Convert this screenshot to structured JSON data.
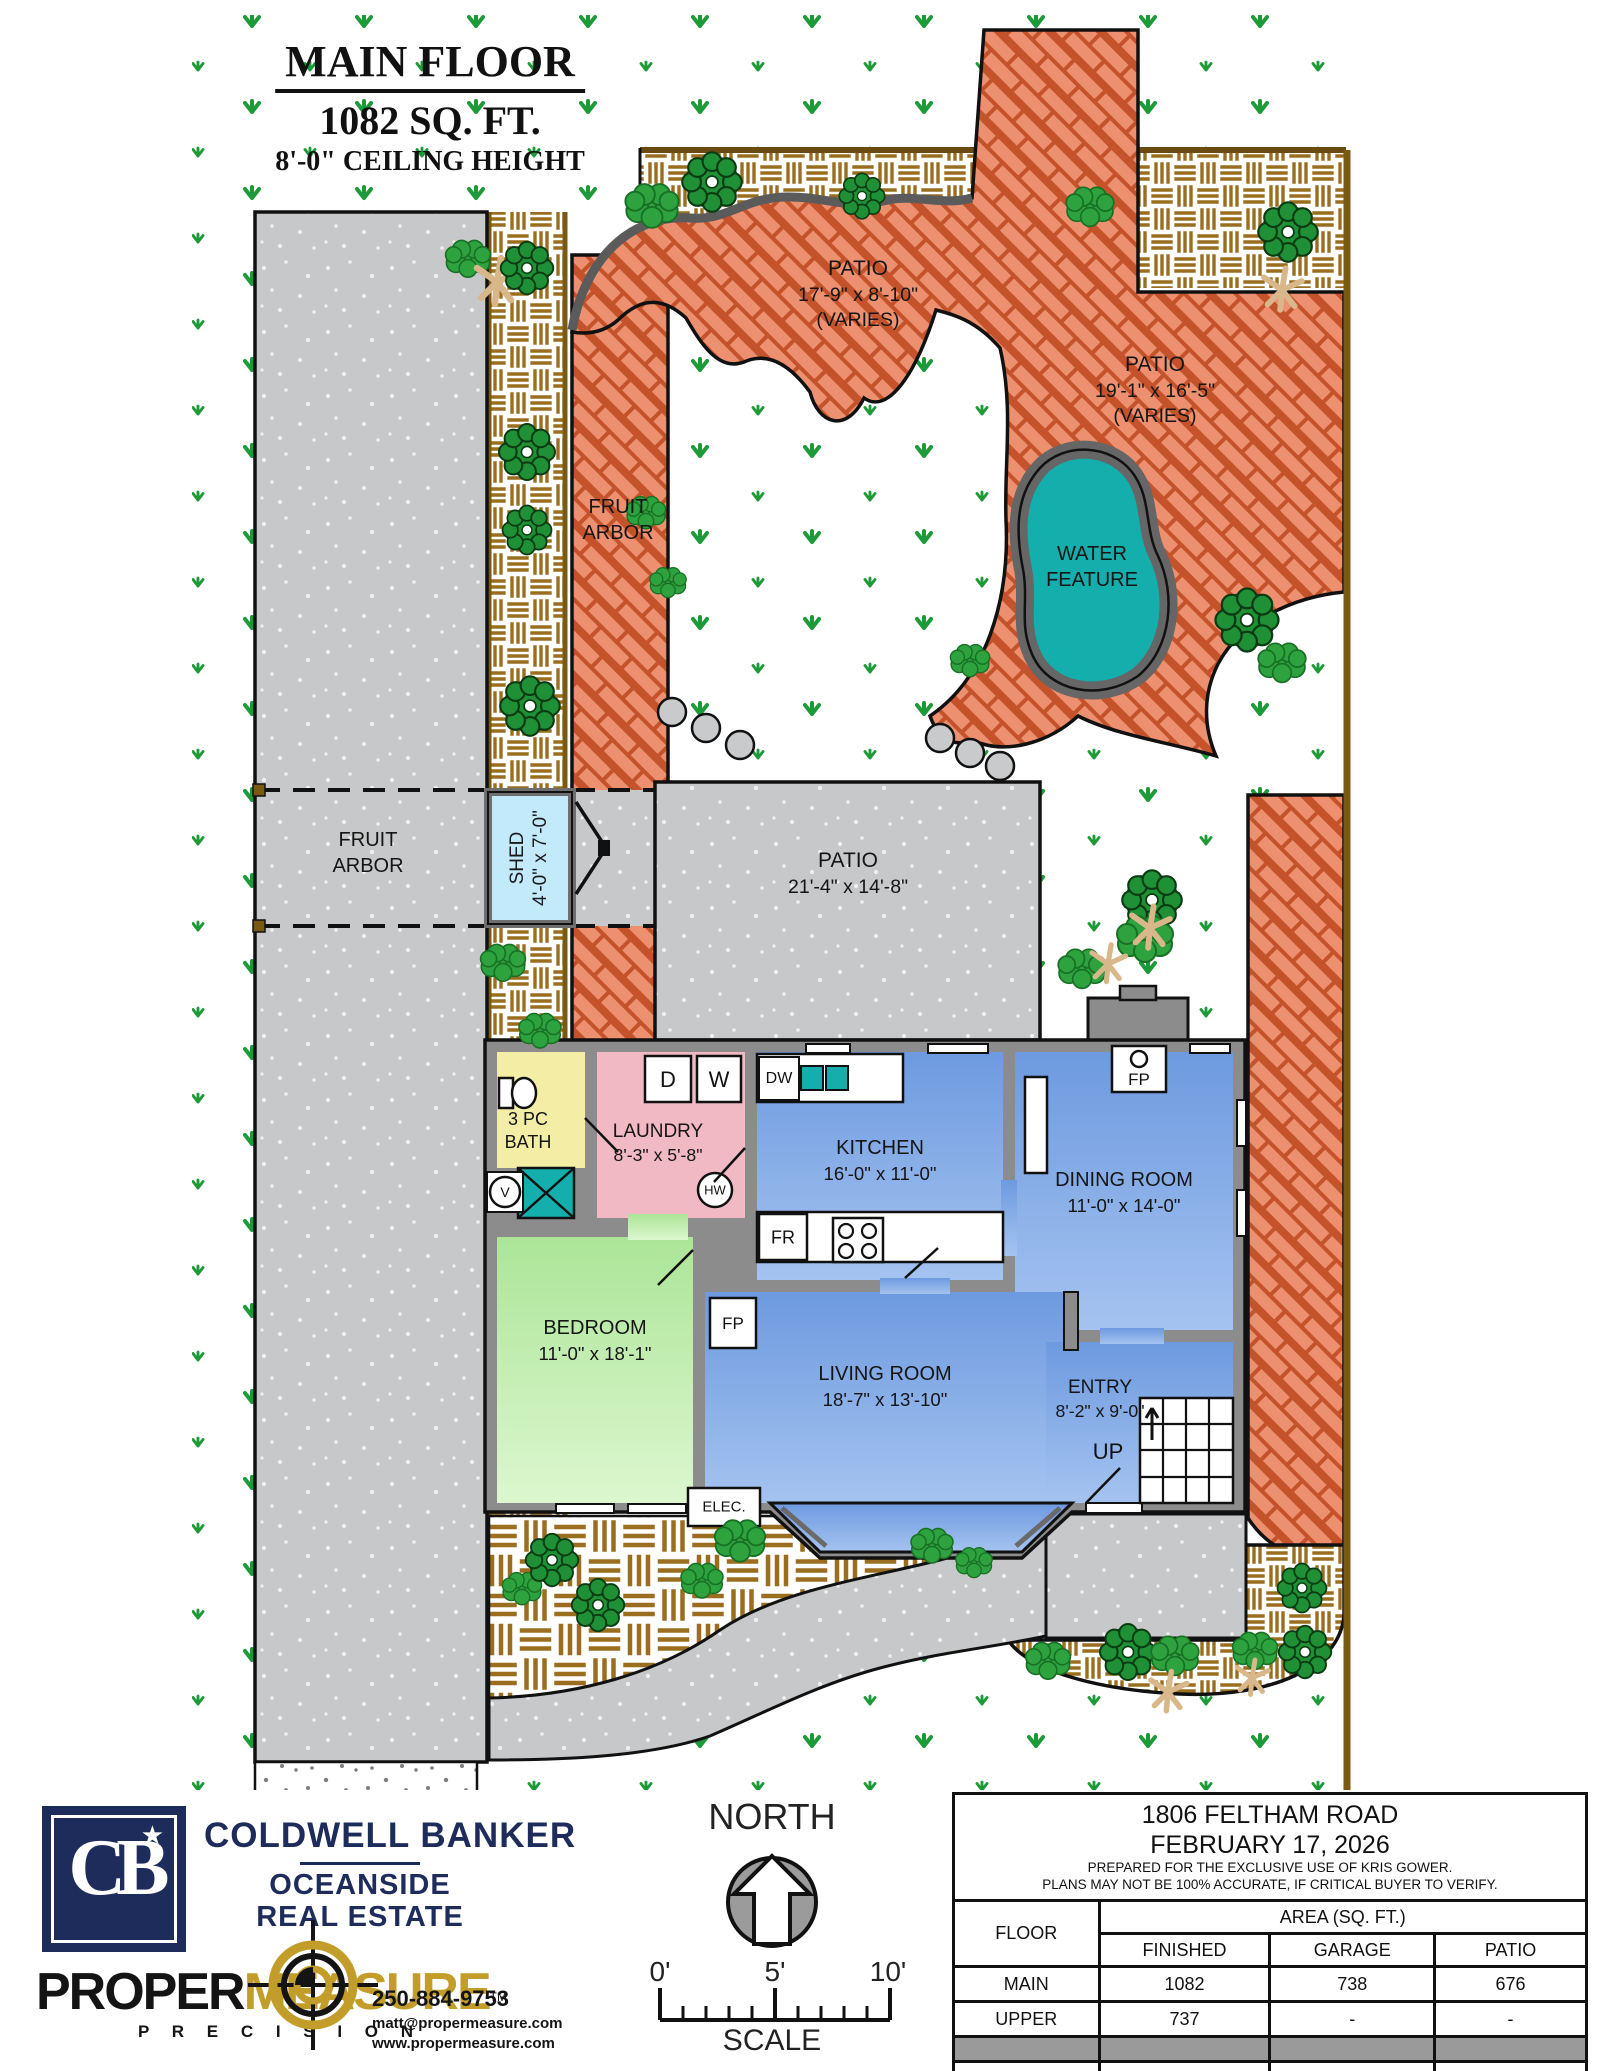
{
  "title": {
    "line1": "MAIN FLOOR",
    "line2": "1082 SQ. FT.",
    "line3": "8'-0\" CEILING HEIGHT"
  },
  "site": {
    "patio_upper": {
      "name": "PATIO",
      "dims": "17'-9\" x 8'-10\"",
      "note": "(VARIES)"
    },
    "patio_right": {
      "name": "PATIO",
      "dims": "19'-1\" x 16'-5\"",
      "note": "(VARIES)"
    },
    "patio_mid": {
      "name": "PATIO",
      "dims": "21'-4\" x 14'-8\""
    },
    "water_feature": {
      "line1": "WATER",
      "line2": "FEATURE"
    },
    "fruit_arbor_path": {
      "line1": "FRUIT",
      "line2": "ARBOR"
    },
    "fruit_arbor_court": {
      "line1": "FRUIT",
      "line2": "ARBOR"
    },
    "shed": {
      "name": "SHED",
      "dims": "4'-0\" x 7'-0\""
    }
  },
  "rooms": {
    "bath": {
      "line1": "3 PC",
      "line2": "BATH"
    },
    "laundry": {
      "name": "LAUNDRY",
      "dims": "8'-3\" x 5'-8\""
    },
    "kitchen": {
      "name": "KITCHEN",
      "dims": "16'-0\" x 11'-0\""
    },
    "dining": {
      "name": "DINING ROOM",
      "dims": "11'-0\" x 14'-0\""
    },
    "bedroom": {
      "name": "BEDROOM",
      "dims": "11'-0\" x 18'-1\""
    },
    "living": {
      "name": "LIVING ROOM",
      "dims": "18'-7\" x 13'-10\""
    },
    "entry": {
      "name": "ENTRY",
      "dims": "8'-2\" x 9'-0\""
    }
  },
  "markers": {
    "up": "UP",
    "elec": "ELEC.",
    "fp": "FP",
    "washer": "W",
    "dryer": "D",
    "dishwasher": "DW",
    "fridge": "FR",
    "hot_water": "HW",
    "vanity": "V"
  },
  "footer": {
    "coldwell": {
      "logo": "CB",
      "star": "★",
      "brand": "COLDWELL BANKER",
      "office1": "OCEANSIDE",
      "office2": "REAL ESTATE"
    },
    "propermeasure": {
      "word1": "PROPER",
      "word2": "MEASURE",
      "tm": "TM",
      "tagline": "P R E C I S I O N",
      "phone": "250-884-9753",
      "email": "matt@propermeasure.com",
      "website": "www.propermeasure.com"
    },
    "north_label": "NORTH",
    "scale": {
      "t0": "0'",
      "t5": "5'",
      "t10": "10'",
      "label": "SCALE"
    }
  },
  "info_table": {
    "address": "1806 FELTHAM ROAD",
    "date": "FEBRUARY 17, 2026",
    "note1": "PREPARED FOR THE EXCLUSIVE USE OF KRIS GOWER.",
    "note2": "PLANS MAY NOT BE 100% ACCURATE, IF CRITICAL BUYER TO VERIFY.",
    "col_floor": "FLOOR",
    "col_area": "AREA (SQ. FT.)",
    "col_finished": "FINISHED",
    "col_garage": "GARAGE",
    "col_patio": "PATIO",
    "rows": [
      {
        "floor": "MAIN",
        "finished": "1082",
        "garage": "738",
        "patio": "676"
      },
      {
        "floor": "UPPER",
        "finished": "737",
        "garage": "-",
        "patio": "-"
      }
    ],
    "total": {
      "floor": "TOTAL",
      "finished": "1819",
      "garage": "738",
      "patio": "676"
    }
  },
  "colors": {
    "brick": "#EC9070",
    "brick_line": "#C4532C",
    "water": "#14AEAC",
    "navy": "#1E2C5C",
    "gold": "#C29D2A",
    "grass_mark": "#1C9A38",
    "concrete": "#C7C8C9"
  }
}
